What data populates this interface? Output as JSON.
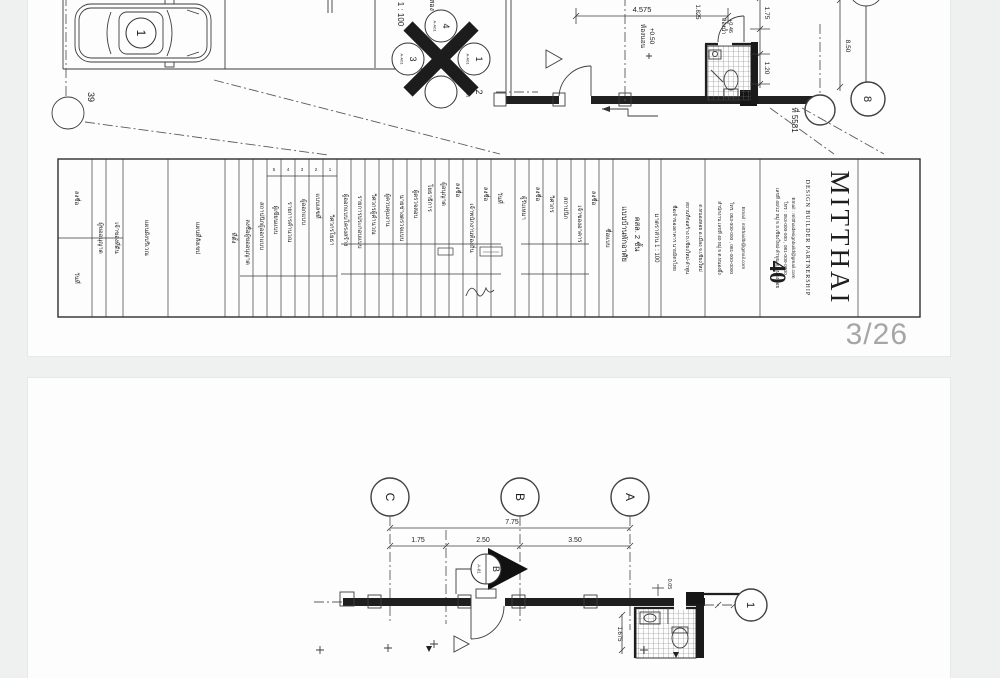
{
  "viewer": {
    "page_indicator": "3/26"
  },
  "page1": {
    "scale_text": "1 : 100",
    "cut_title": "แปลนพื้นชั้นสอง",
    "parking": {
      "stall_number": "1",
      "detail_bubble": "39"
    },
    "compass": {
      "top": "4",
      "right": "1",
      "bottom": "2",
      "left": "3",
      "ref": "A-A01"
    },
    "plan": {
      "dim_top": "4.575",
      "room_label": "ห้องนอน",
      "room_level": "+0.50",
      "bath_label": "ห้องน้ำ",
      "bath_level": "+0.46",
      "dim_right_1": "1.75",
      "dim_right_2": "1.20",
      "dim_right_3": "8.50",
      "dim_inner": "1.825",
      "site_ref": "ที่ 5581",
      "grid_bubble": "8"
    },
    "titleblock": {
      "header_numbers": [
        "5",
        "4",
        "3",
        "2",
        "1"
      ],
      "columns": [
        "ลงชื่อ",
        "วันที่",
        "ผู้ขออนุญาต",
        "เจ้าของที่ดิน",
        "แผนผังบริเวณ",
        "แผนที่สังเขป",
        "ที่ตั้ง",
        "ลงชื่อผู้ขออนุญาต",
        "สถาปนิกผู้ออกแบบ",
        "ผู้เขียนแบบ",
        "รายการคำนวณ",
        "ผู้ออกแบบ",
        "แบบเลขที่",
        "วิศวกรโยธา",
        "ผู้ออกแบบโครงสร้าง",
        "รายการประกอบแบบ",
        "วิศวกรผู้คำนวณ",
        "ผู้ควบคุมงาน",
        "นายช่างตรวจแบบ",
        "ผู้ตรวจสอบ",
        "โยธาธิการ",
        "ผู้อนุญาต",
        "ลงชื่อ",
        "เจ้าพนักงานท้องถิ่น",
        "ลงชื่อ",
        "วันที่",
        "ผู้รับเหมา",
        "ลงชื่อ",
        "วิศวกร",
        "สถาปนิก",
        "เจ้าของอาคาร",
        "ลงชื่อ",
        "ชื่อแบบ",
        "แบบบ้านพักอาศัย",
        "คสล. 2 ชั้น",
        "มาตราส่วน 1 : 100",
        "ชื่อเจ้าของอาคาร นายมิตรไทย",
        "สถานที่ก่อสร้าง ถ.เชียงใหม่-ลำพูน",
        "ต.หนองหอย อ.เมือง จ.เชียงใหม่",
        "สำนักงาน เลขที่ 40 หมู่ 5 ต.หนองผึ้ง",
        "โทร. 053-000-000 , 081-000-0000",
        "Email : mitthaidb@gmail.com"
      ],
      "mitthai": {
        "name": "MITTHAI",
        "subtitle": "DESIGN BUILDER PARTNERSHIP",
        "address": "เลขที่ 40/12 หมู่ 5 ถ.เชียงใหม่-ลำพูน ต.หนองหอย",
        "phone": "โทร : 053-000-000 , 081-000-0000",
        "email": "Email : mitthaidesignbuild@gmail.com",
        "big_number": "40"
      }
    }
  },
  "page2": {
    "grid": {
      "c": "C",
      "b": "B",
      "a": "A",
      "one": "1"
    },
    "dims": {
      "total": "7.75",
      "seg1": "1.75",
      "seg2": "2.50",
      "seg3": "3.50",
      "left": "1.675",
      "small": "0.05"
    },
    "section_marker": {
      "letter": "B",
      "sheet": "A-01"
    }
  }
}
